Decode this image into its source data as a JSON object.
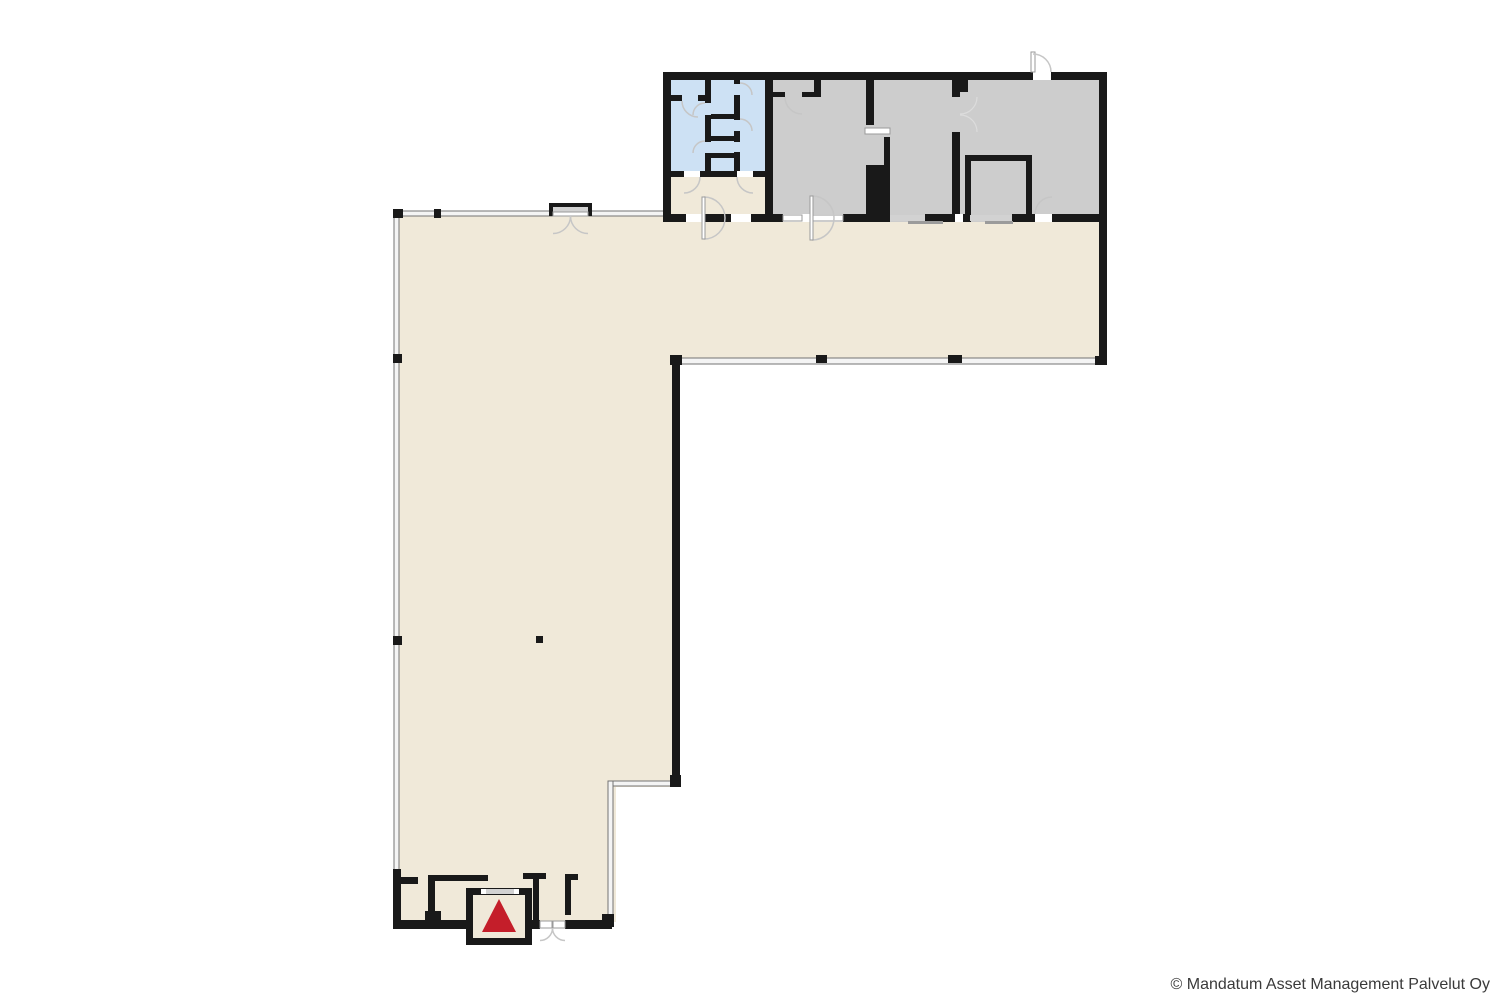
{
  "page": {
    "background": "#ffffff"
  },
  "footer": {
    "copyright": "© Mandatum Asset Management Palvelut Oy"
  },
  "colors": {
    "floor-main": "#f0e9d9",
    "floor-wet": "#cde1f4",
    "floor-room": "#cdcdcd",
    "wall": "#191919",
    "window-fill": "#f4f4f4",
    "window-edge": "#737373",
    "door-arc": "#c6c6c6",
    "leaf-edge": "#9a9a9a",
    "recess": "#d2d2d2",
    "slide-leaf": "#9b9b9b",
    "elevator-red": "#c41e2a",
    "text": "#3a3a3a"
  },
  "icons": {
    "elevator_marker": "red-up-triangle"
  },
  "plan": {
    "type": "floor-plan",
    "areas": [
      {
        "name": "main-hall",
        "fill": "floor-main"
      },
      {
        "name": "vestibule",
        "fill": "floor-main"
      },
      {
        "name": "wet-room-block",
        "fill": "floor-wet"
      },
      {
        "name": "room-1",
        "fill": "floor-room"
      },
      {
        "name": "room-2",
        "fill": "floor-room"
      },
      {
        "name": "room-3",
        "fill": "floor-room"
      },
      {
        "name": "inner-room",
        "fill": "floor-room"
      },
      {
        "name": "elevator",
        "fill": "floor-main"
      }
    ]
  }
}
